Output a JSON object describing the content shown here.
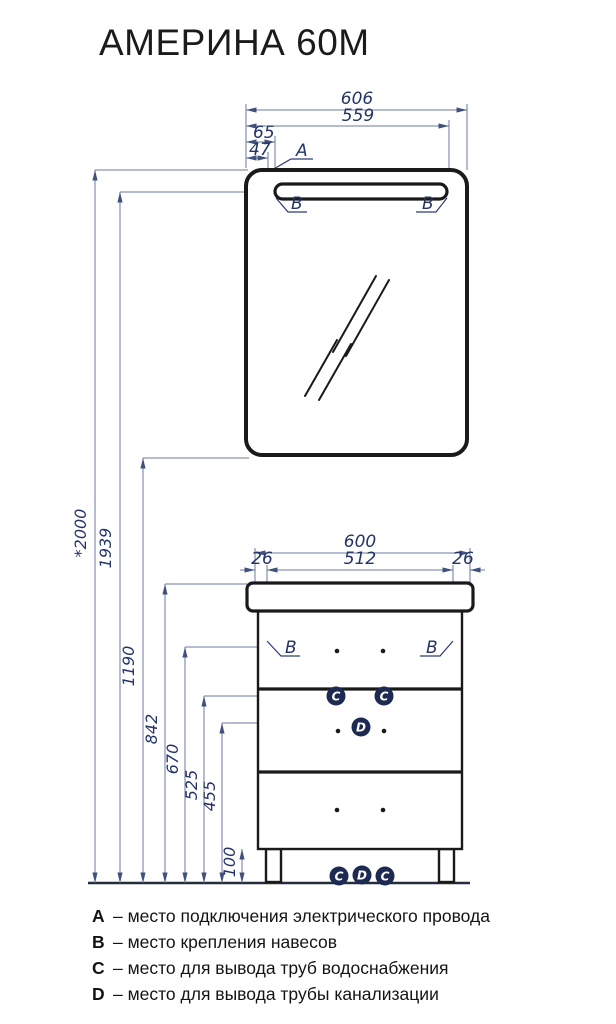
{
  "title": "АМЕРИНА 60М",
  "colors": {
    "outline": "#1a1a1a",
    "dimension_line": "#6b79a0",
    "dimension_text": "#243468",
    "badge_fill": "#1d2a52",
    "badge_text": "#ffffff"
  },
  "mirror_dims": {
    "overall_width": "606",
    "fixing_width": "559",
    "lamp_offset": "65",
    "wire_offset": "47"
  },
  "cabinet_dims": {
    "overall_width": "600",
    "between_fixings": "512",
    "offset_left": "26",
    "offset_right": "26"
  },
  "heights": {
    "overall": "*2000",
    "mirror_fixing": "1939",
    "mirror_bottom": "1190",
    "cabinet_top": "842",
    "cabinet_fixing": "670",
    "water_outlet": "525",
    "drain_outlet": "455",
    "legs": "100"
  },
  "markers": {
    "a": "A",
    "b": "B",
    "c": "C",
    "d": "D"
  },
  "legend": [
    {
      "key": "A",
      "text": "– место подключения электрического провода"
    },
    {
      "key": "B",
      "text": "– место крепления навесов"
    },
    {
      "key": "C",
      "text": "– место для вывода труб водоснабжения"
    },
    {
      "key": "D",
      "text": "– место для вывода трубы канализации"
    }
  ]
}
